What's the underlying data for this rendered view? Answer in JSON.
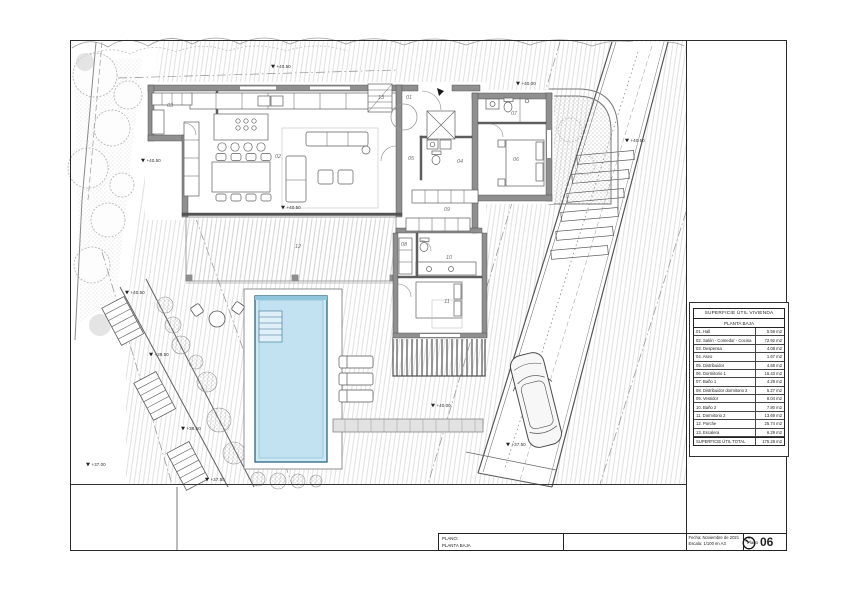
{
  "sheet": {
    "plano_label": "PLANO:",
    "plano_value": "PLANTA BAJA",
    "fecha": "Fecha: Noviembre de 2021",
    "escala": "Escala: 1/100 en A3",
    "sheet_label": "Plano",
    "sheet_number": "06"
  },
  "area_table": {
    "title": "SUPERFICIE ÚTIL VIVIENDA",
    "subtitle": "PLANTA BAJA",
    "rows": [
      {
        "label": "01. Hall",
        "value": "5.59 m2"
      },
      {
        "label": "02. Salón - Comedor - Cocina",
        "value": "72.92 m2"
      },
      {
        "label": "03. Despensa",
        "value": "4.08 m2"
      },
      {
        "label": "04. Aseo",
        "value": "1.67 m2"
      },
      {
        "label": "05. Distribuidor",
        "value": "4.68 m2"
      },
      {
        "label": "06. Dormitorio 1",
        "value": "15.43 m2"
      },
      {
        "label": "07. Baño 1",
        "value": "4.29 m2"
      },
      {
        "label": "08. Distribuidor dormitorio 2",
        "value": "5.27 m2"
      },
      {
        "label": "09. Vestidor",
        "value": "8.04 m2"
      },
      {
        "label": "10. Baño 2",
        "value": "7.80 m2"
      },
      {
        "label": "11. Dormitorio 2",
        "value": "13.69 m2"
      },
      {
        "label": "12. Porche",
        "value": "25.74 m2"
      },
      {
        "label": "13. Escalera",
        "value": "6.29 m2"
      }
    ],
    "total": {
      "label": "SUPERFICIE ÚTIL TOTAL",
      "value": "175.28 m2"
    }
  },
  "plan": {
    "room_labels": [
      {
        "id": "01",
        "x": 409,
        "y": 99
      },
      {
        "id": "02",
        "x": 278,
        "y": 158
      },
      {
        "id": "03",
        "x": 170,
        "y": 107
      },
      {
        "id": "04",
        "x": 460,
        "y": 163
      },
      {
        "id": "05",
        "x": 411,
        "y": 160
      },
      {
        "id": "06",
        "x": 516,
        "y": 161
      },
      {
        "id": "07",
        "x": 514,
        "y": 115
      },
      {
        "id": "08",
        "x": 404,
        "y": 246
      },
      {
        "id": "09",
        "x": 447,
        "y": 211
      },
      {
        "id": "10",
        "x": 449,
        "y": 259
      },
      {
        "id": "11",
        "x": 447,
        "y": 303
      },
      {
        "id": "12",
        "x": 298,
        "y": 248
      },
      {
        "id": "13",
        "x": 381,
        "y": 99
      }
    ],
    "elevation_marks": [
      {
        "text": "+40.50",
        "x": 273,
        "y": 68
      },
      {
        "text": "+40.00",
        "x": 518,
        "y": 85
      },
      {
        "text": "+40.50",
        "x": 627,
        "y": 142
      },
      {
        "text": "+40.50",
        "x": 143,
        "y": 162
      },
      {
        "text": "+40.50",
        "x": 283,
        "y": 209
      },
      {
        "text": "+40.00",
        "x": 433,
        "y": 407
      },
      {
        "text": "+40.50",
        "x": 127,
        "y": 294
      },
      {
        "text": "+39.50",
        "x": 151,
        "y": 356
      },
      {
        "text": "+38.50",
        "x": 183,
        "y": 430
      },
      {
        "text": "+37.50",
        "x": 207,
        "y": 481
      },
      {
        "text": "+37.50",
        "x": 508,
        "y": 446
      },
      {
        "text": "+37.00",
        "x": 88,
        "y": 466
      }
    ],
    "colors": {
      "pool_water": "#c2e2f1",
      "pool_edge": "#35708e",
      "wall": "#8f8f8f"
    }
  }
}
